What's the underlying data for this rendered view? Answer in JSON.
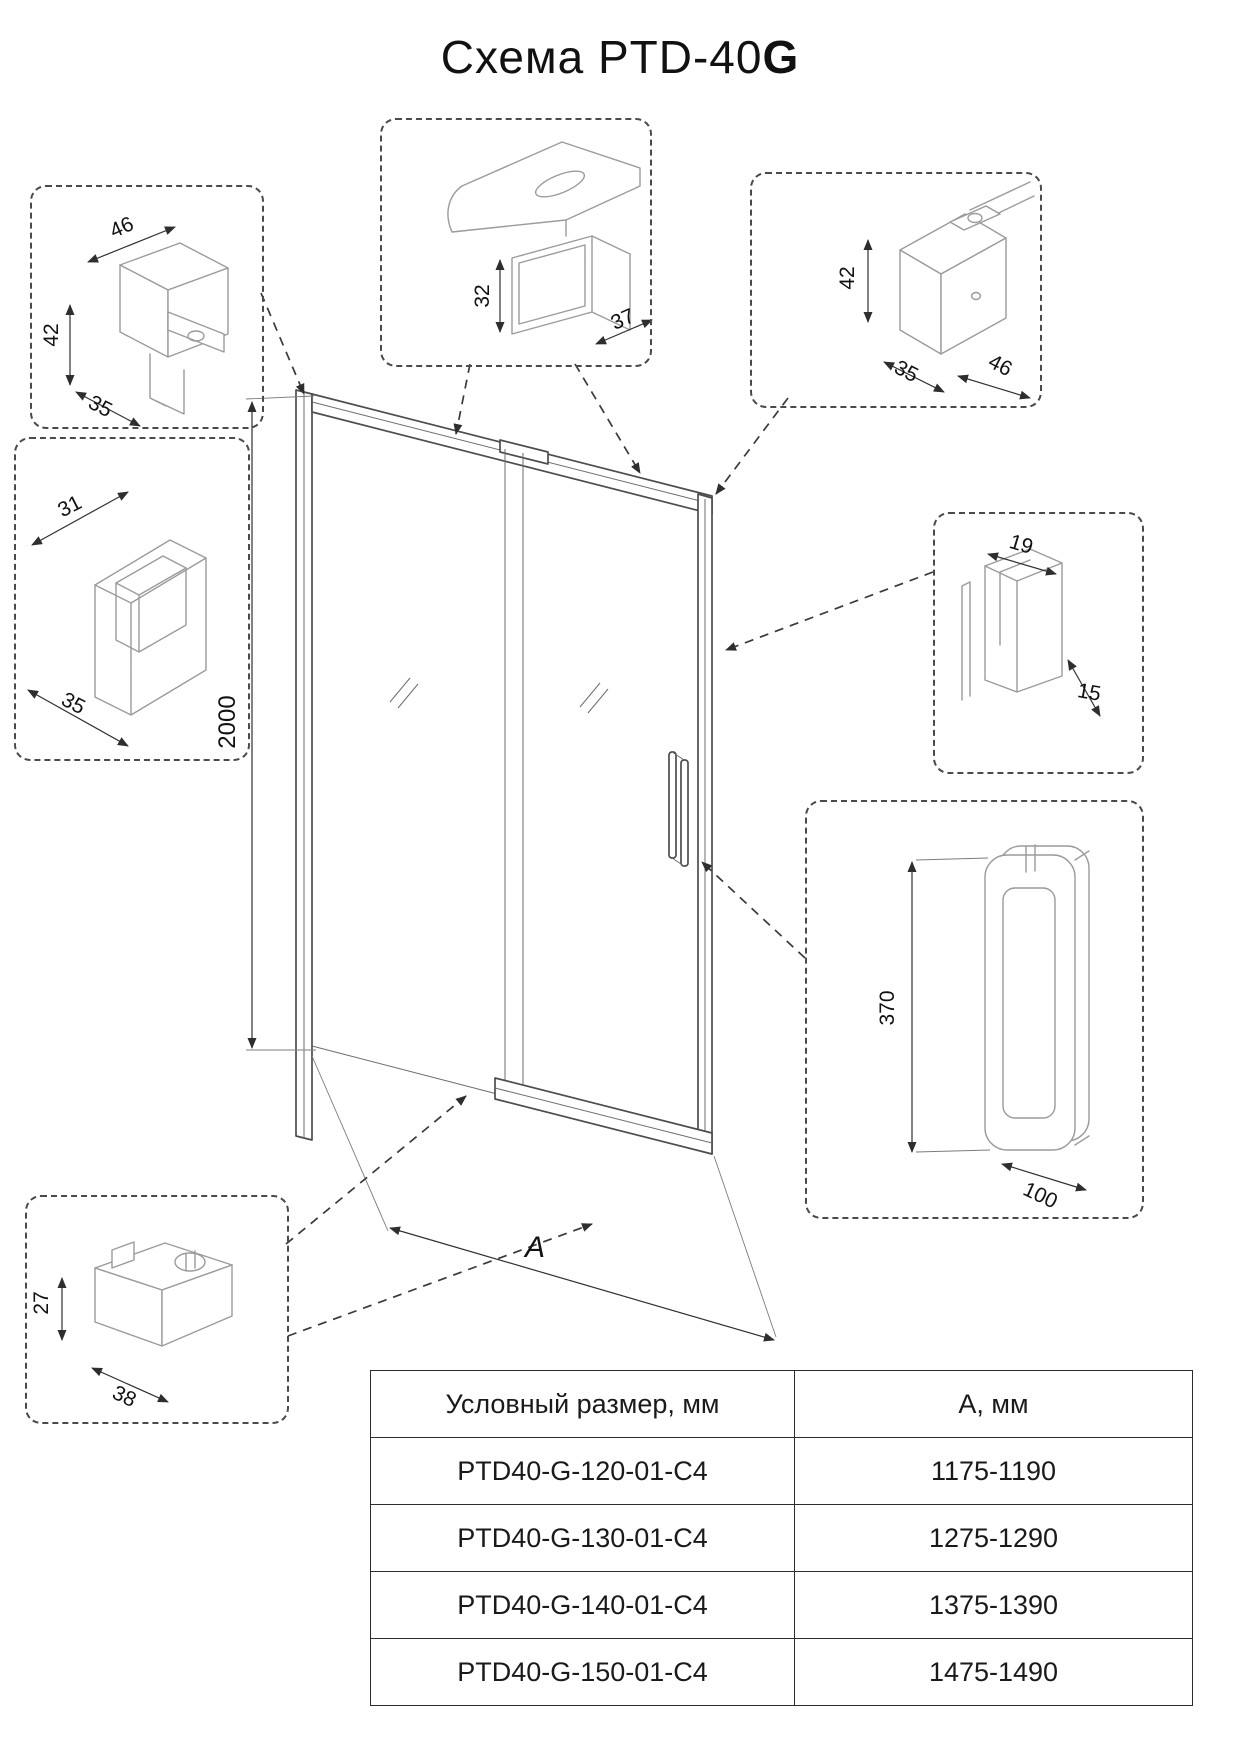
{
  "title": {
    "main": "Схема PTD-40",
    "bold_suffix": "G"
  },
  "main_drawing": {
    "height_dim": "2000",
    "width_dim": "А"
  },
  "details": {
    "top_rail_clamp": {
      "width": "46",
      "height": "42",
      "depth": "35"
    },
    "top_rail_profile": {
      "height": "32",
      "depth": "37"
    },
    "wall_rail_bracket": {
      "height": "42",
      "depth": "35",
      "width": "46"
    },
    "wall_profile": {
      "width": "31",
      "depth": "35"
    },
    "glass_edge_profile": {
      "width": "19",
      "depth": "15"
    },
    "door_handle": {
      "height": "370",
      "width": "100"
    },
    "bottom_guide_bracket": {
      "height": "27",
      "depth": "38"
    }
  },
  "size_table": {
    "headers": [
      "Условный размер, мм",
      "А, мм"
    ],
    "rows": [
      [
        "PTD40-G-120-01-C4",
        "1175-1190"
      ],
      [
        "PTD40-G-130-01-C4",
        "1275-1290"
      ],
      [
        "PTD40-G-140-01-C4",
        "1375-1390"
      ],
      [
        "PTD40-G-150-01-C4",
        "1475-1490"
      ]
    ]
  }
}
